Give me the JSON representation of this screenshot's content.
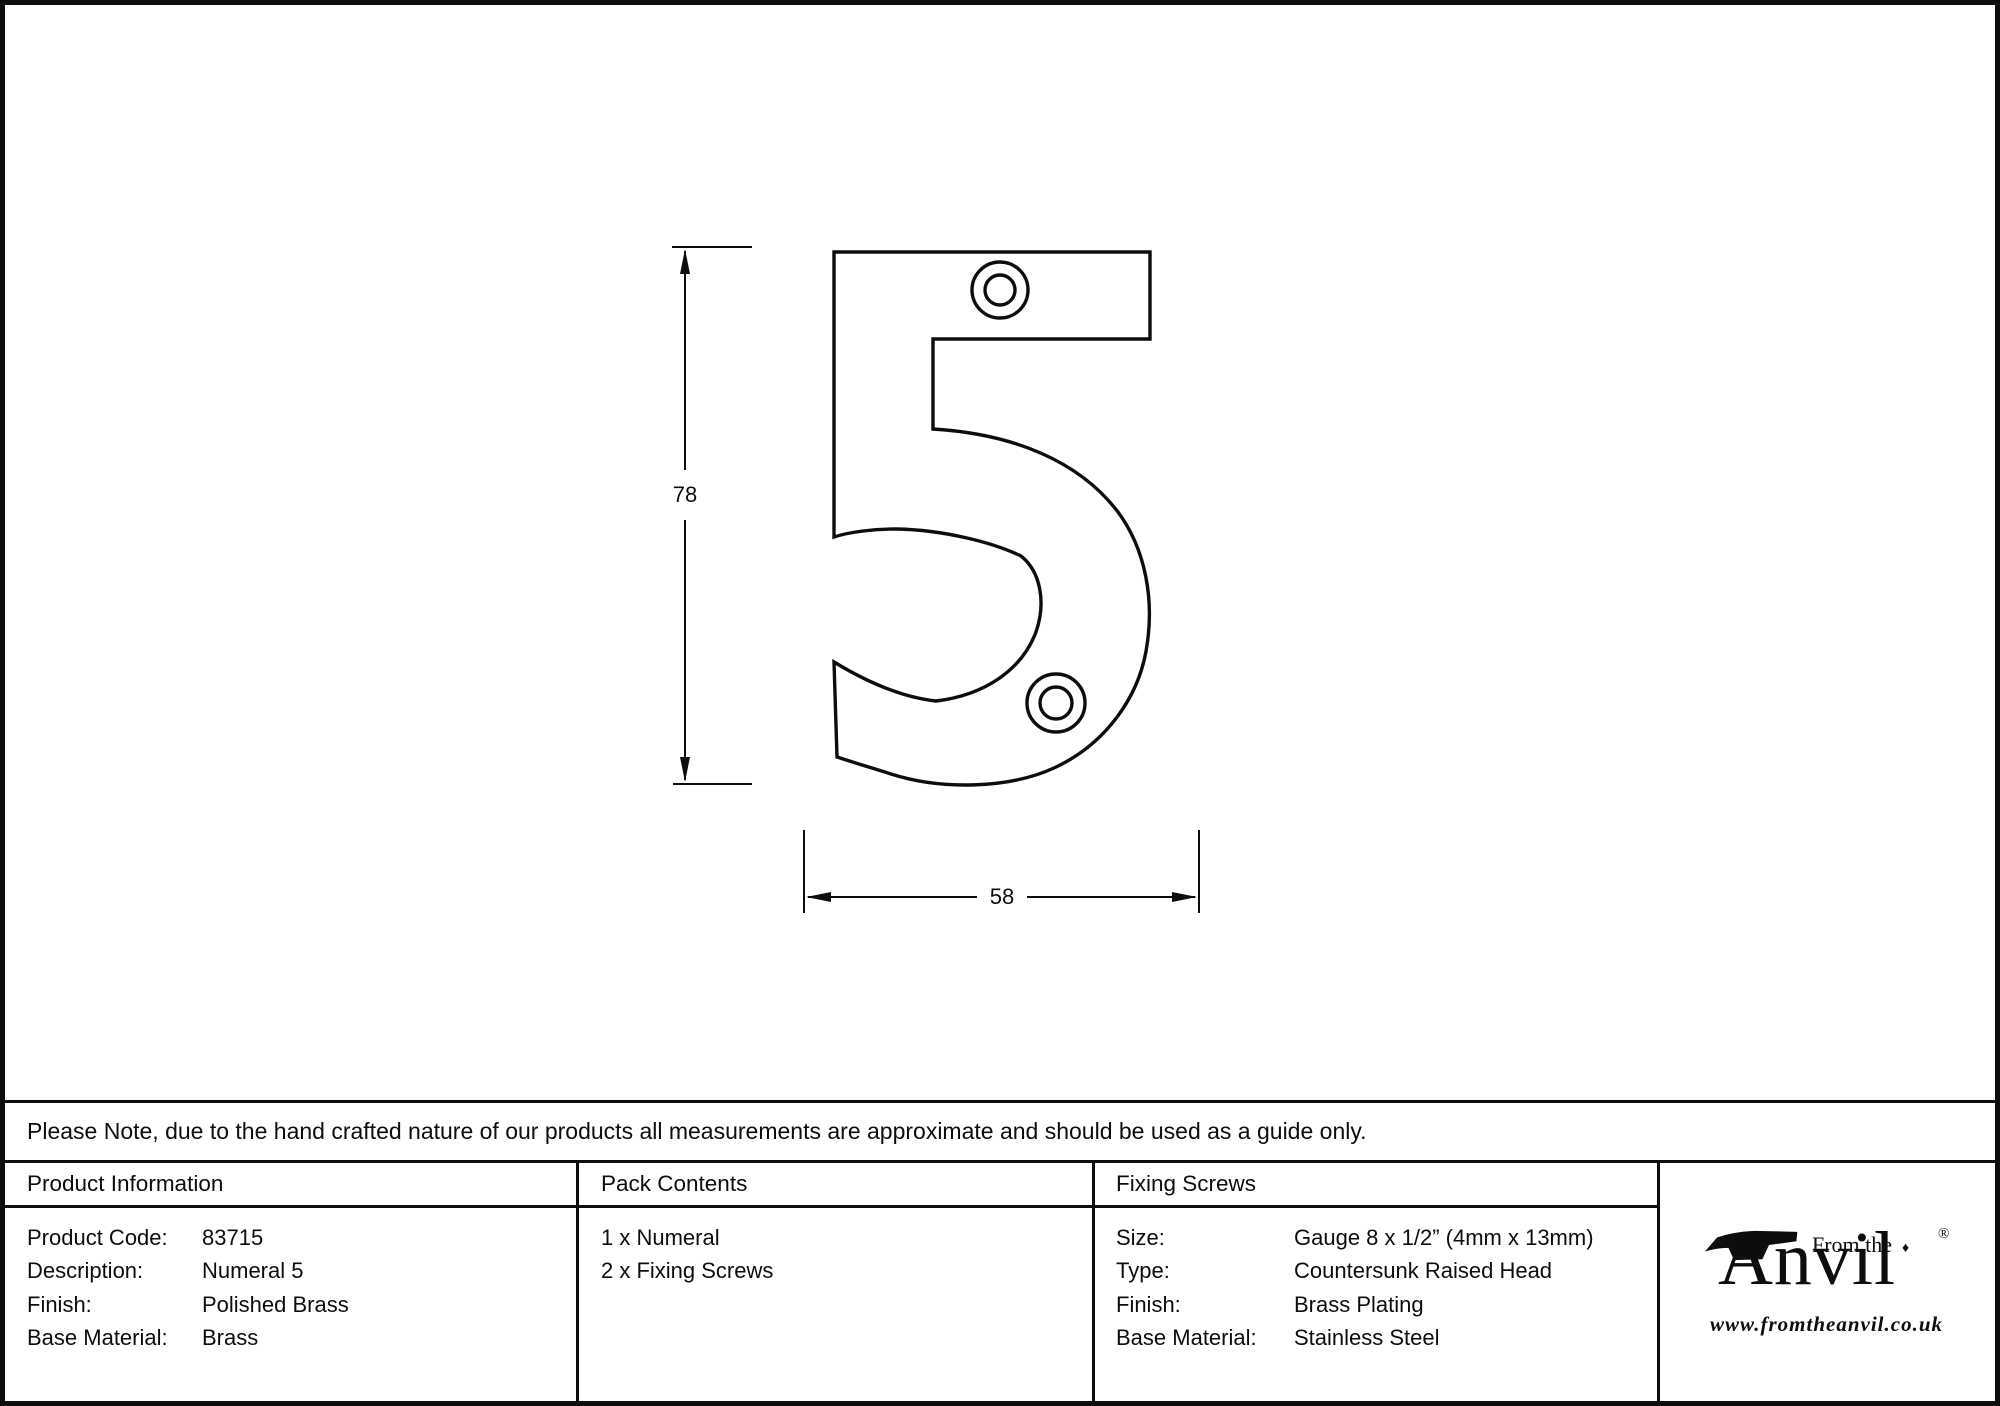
{
  "page": {
    "background": "#ffffff",
    "ink": "#0d0d0d"
  },
  "drawing": {
    "subject": "numeral-5-outline-with-two-screw-holes",
    "height_dim_label": "78",
    "width_dim_label": "58"
  },
  "disclaimer": {
    "text": "Please Note, due to the hand crafted nature of our products all measurements are approximate and should be used as a guide only."
  },
  "table": {
    "col1_header": "Product Information",
    "col2_header": "Pack Contents",
    "col3_header": "Fixing Screws",
    "product_info_rows": [
      {
        "label": "Product Code:",
        "value": "83715"
      },
      {
        "label": "Description:",
        "value": "Numeral 5"
      },
      {
        "label": "Finish:",
        "value": "Polished Brass"
      },
      {
        "label": "Base Material:",
        "value": "Brass"
      }
    ],
    "pack_contents_items": [
      "1 x Numeral",
      "2 x Fixing Screws"
    ],
    "fixing_screws_rows": [
      {
        "label": "Size:",
        "value": "Gauge 8 x 1/2” (4mm x 13mm)"
      },
      {
        "label": "Type:",
        "value": "Countersunk Raised Head"
      },
      {
        "label": "Finish:",
        "value": "Brass Plating"
      },
      {
        "label": "Base Material:",
        "value": "Stainless Steel"
      }
    ]
  },
  "logo": {
    "from_the": "From the",
    "anvil": "Anvil",
    "diamond": "♦",
    "registered": "®",
    "url": "www.fromtheanvil.co.uk"
  }
}
